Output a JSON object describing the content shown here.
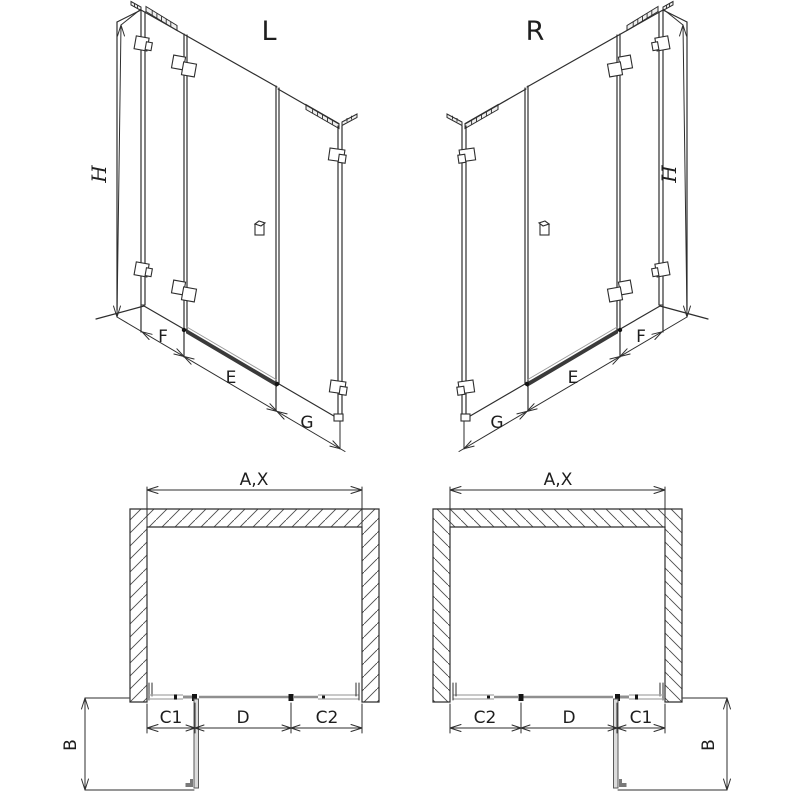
{
  "views": {
    "iso_left": {
      "variant_label": "L",
      "height_label": "H",
      "width_labels": [
        "F",
        "E",
        "G"
      ]
    },
    "iso_right": {
      "variant_label": "R",
      "height_label": "H",
      "width_labels": [
        "G",
        "E",
        "F"
      ]
    },
    "plan_left": {
      "width_label": "A,X",
      "segment_labels": [
        "C1",
        "D",
        "C2"
      ],
      "depth_label": "B"
    },
    "plan_right": {
      "width_label": "A,X",
      "segment_labels": [
        "C2",
        "D",
        "C1"
      ],
      "depth_label": "B"
    }
  },
  "colors": {
    "background": "#ffffff",
    "line": "#2e2e2e",
    "glass": "#8f8f8f",
    "rail": "#a6a6a6",
    "threshold": "#3a3a3a",
    "hatch": "#4a4a4a"
  }
}
